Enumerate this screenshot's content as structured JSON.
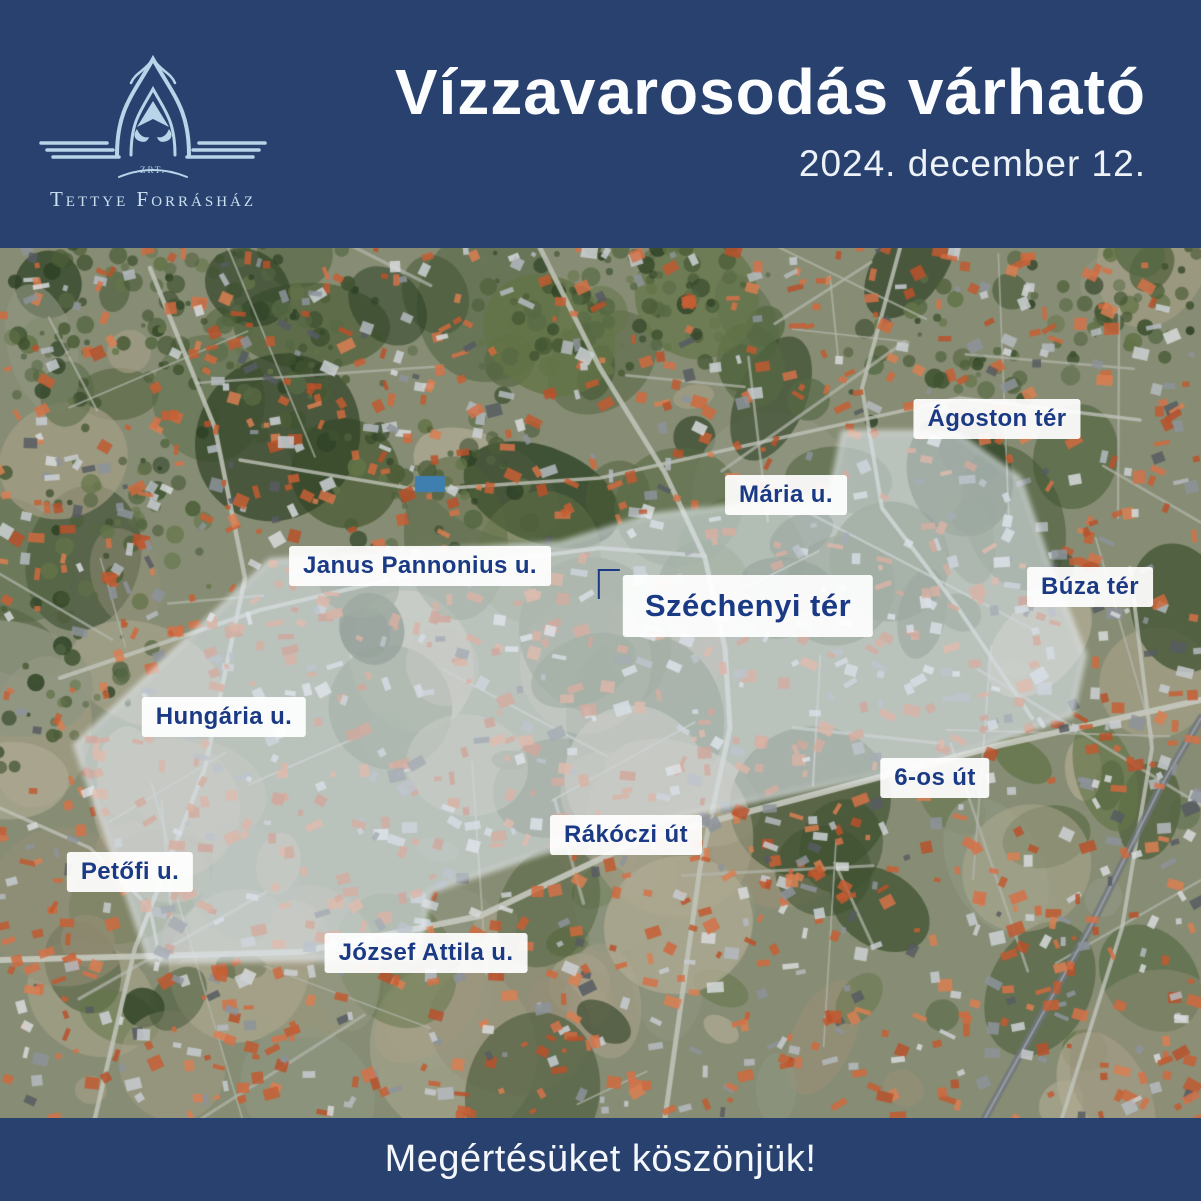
{
  "header": {
    "logo": {
      "company_suffix": "ZRT.",
      "company_name": "Tettye Forrásház"
    },
    "title": "Vízzavarosodás várható",
    "date": "2024. december 12."
  },
  "map": {
    "labels": [
      {
        "id": "agoston-ter",
        "text": "Ágoston tér"
      },
      {
        "id": "maria-u",
        "text": "Mária u."
      },
      {
        "id": "janus-pannonius-u",
        "text": "Janus Pannonius u."
      },
      {
        "id": "szechenyi-ter",
        "text": "Széchenyi tér"
      },
      {
        "id": "buza-ter",
        "text": "Búza tér"
      },
      {
        "id": "hungaria-u",
        "text": "Hungária u."
      },
      {
        "id": "6-os-ut",
        "text": "6-os út"
      },
      {
        "id": "rakoczi-ut",
        "text": "Rákóczi út"
      },
      {
        "id": "petofi-u",
        "text": "Petőfi u."
      },
      {
        "id": "jozsef-attila-u",
        "text": "József Attila u."
      }
    ]
  },
  "footer": {
    "message": "Megértésüket köszönjük!"
  },
  "colors": {
    "brand_navy": "#29416f",
    "label_text_navy": "#1a3a85",
    "logo_light_blue": "#b7d4e9",
    "highlight_overlay": "rgba(224,233,242,0.58)"
  }
}
